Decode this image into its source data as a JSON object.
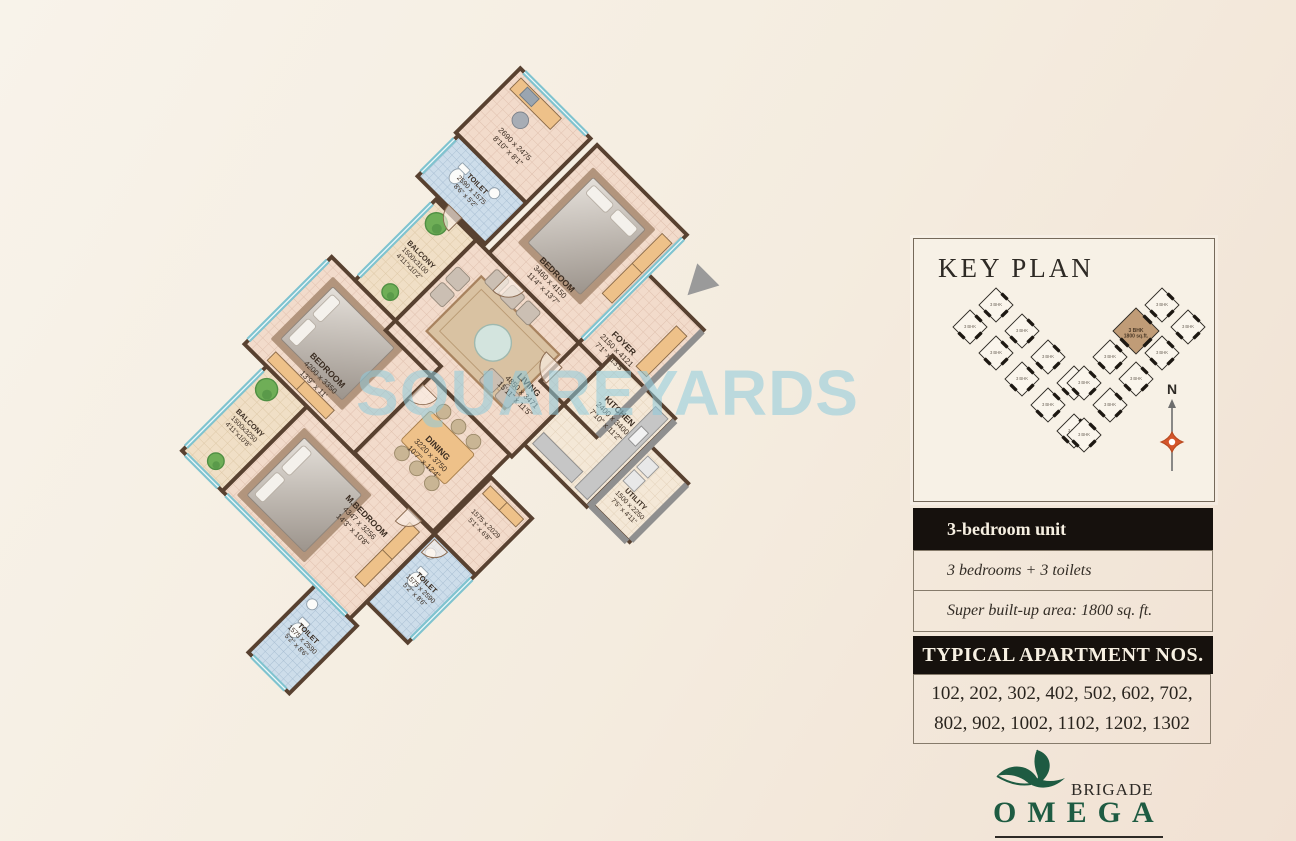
{
  "watermark": "SQUAREYARDS",
  "colors": {
    "wall": "#584130",
    "window": "#7fc3cf",
    "accent_wood": "#eec189",
    "toilet_floor": "#cdddea",
    "room_floor": "#f2dbcb",
    "plant": "#6fae57",
    "dark_bar": "#16110d",
    "brand_green": "#1e5b42",
    "compass": "#d4552b",
    "keyplan_highlight": "#c09c77",
    "watermark_blue": "#8ecbdd"
  },
  "floor_plan": {
    "rooms": [
      {
        "id": "study",
        "name": "",
        "dim_mm": "2690 x 2475",
        "dim_ft": "8'10\" x 8'1\"",
        "type": "room",
        "x": 0,
        "y": 0,
        "w": 108,
        "h": 99
      },
      {
        "id": "toilet1",
        "name": "TOILET",
        "dim_mm": "2590 x 1575",
        "dim_ft": "8'6\" x 5'2\"",
        "type": "toilet",
        "x": 4,
        "y": 99,
        "w": 104,
        "h": 63
      },
      {
        "id": "bedroom1",
        "name": "BEDROOM",
        "dim_mm": "3460 x 4150",
        "dim_ft": "11'4\" x 13'7\"",
        "type": "bedroom",
        "x": 118,
        "y": 0,
        "w": 138,
        "h": 166
      },
      {
        "id": "foyer",
        "name": "FOYER",
        "dim_mm": "2150 x 4121",
        "dim_ft": "7'1\" x 13'5\"",
        "type": "room",
        "x": 256,
        "y": 60,
        "w": 86,
        "h": 165
      },
      {
        "id": "balcony-u",
        "name": "BALCONY",
        "dim_mm": "1500x3100",
        "dim_ft": "4'11\"x10'2\"",
        "type": "balcony",
        "x": 36,
        "y": 166,
        "w": 62,
        "h": 124
      },
      {
        "id": "living",
        "name": "LIVING",
        "dim_mm": "4850 x 3471",
        "dim_ft": "15'11\" x 11'5\"",
        "type": "room",
        "x": 98,
        "y": 166,
        "w": 194,
        "h": 139
      },
      {
        "id": "kitchen",
        "name": "KITCHEN",
        "dim_mm": "2400 x 3400",
        "dim_ft": "7'10\" x 11'2\"",
        "type": "kitchen",
        "x": 292,
        "y": 150,
        "w": 96,
        "h": 136
      },
      {
        "id": "utility",
        "name": "UTILITY",
        "dim_mm": "1500 x 2250",
        "dim_ft": "7'5\" x 4'11\"",
        "type": "utility",
        "x": 388,
        "y": 190,
        "w": 60,
        "h": 90
      },
      {
        "id": "dining",
        "name": "DINING",
        "dim_mm": "3220 x 3750",
        "dim_ft": "10'7\" x 12'4\"",
        "type": "room",
        "x": 168,
        "y": 305,
        "w": 121,
        "h": 118
      },
      {
        "id": "bedroom2",
        "name": "BEDROOM",
        "dim_mm": "4200 x 3350",
        "dim_ft": "13'9\" x 11'",
        "type": "bedroom",
        "x": 0,
        "y": 290,
        "w": 168,
        "h": 134
      },
      {
        "id": "passage",
        "name": "",
        "dim_mm": "1575 x 2029",
        "dim_ft": "5'1\" x 6'8\"",
        "type": "passage",
        "x": 292,
        "y": 337,
        "w": 63,
        "h": 87
      },
      {
        "id": "m-bedroom",
        "name": "M.BEDROOM",
        "dim_mm": "4347 x 3256",
        "dim_ft": "14'3\" x 10'8\"",
        "type": "bedroom",
        "x": 96,
        "y": 424,
        "w": 196,
        "h": 130
      },
      {
        "id": "toilet2",
        "name": "TOILET",
        "dim_mm": "1575 x 2590",
        "dim_ft": "5'2\" x 8'6\"",
        "type": "toilet",
        "x": 292,
        "y": 424,
        "w": 63,
        "h": 104
      },
      {
        "id": "toilet3",
        "name": "TOILET",
        "dim_mm": "1575 x 2590",
        "dim_ft": "5'2\" x 8'6\"",
        "type": "toilet",
        "x": 240,
        "y": 554,
        "w": 63,
        "h": 104
      },
      {
        "id": "balcony-l",
        "name": "BALCONY",
        "dim_mm": "1500x3250",
        "dim_ft": "4'11\"x10'8\"",
        "type": "balcony",
        "x": 34,
        "y": 424,
        "w": 62,
        "h": 130
      }
    ],
    "rotation_deg": 45
  },
  "key_plan": {
    "title": "KEY PLAN",
    "north_label": "N",
    "highlight_label": "3 BHK",
    "highlight_area": "1800 sq.ft.",
    "units": [
      {
        "x": 82,
        "y": 66,
        "label": "3 BHK"
      },
      {
        "x": 108,
        "y": 92,
        "label": "3 BHK"
      },
      {
        "x": 134,
        "y": 118,
        "label": "3 BHK"
      },
      {
        "x": 160,
        "y": 144,
        "label": "3 BHK"
      },
      {
        "x": 56,
        "y": 88,
        "label": "3 BHK"
      },
      {
        "x": 82,
        "y": 114,
        "label": "3 BHK"
      },
      {
        "x": 108,
        "y": 140,
        "label": "3 BHK"
      },
      {
        "x": 134,
        "y": 166,
        "label": "3 BHK"
      },
      {
        "x": 160,
        "y": 192,
        "label": "3 BHK"
      },
      {
        "x": 248,
        "y": 66,
        "label": "3 BHK"
      },
      {
        "x": 222,
        "y": 92,
        "label": "3 BHK",
        "highlight": true
      },
      {
        "x": 196,
        "y": 118,
        "label": "3 BHK"
      },
      {
        "x": 170,
        "y": 144,
        "label": "3 BHK"
      },
      {
        "x": 274,
        "y": 88,
        "label": "3 BHK"
      },
      {
        "x": 248,
        "y": 114,
        "label": "3 BHK"
      },
      {
        "x": 222,
        "y": 140,
        "label": "3 BHK"
      },
      {
        "x": 196,
        "y": 166,
        "label": "3 BHK"
      },
      {
        "x": 170,
        "y": 196,
        "label": "3 BHK"
      }
    ]
  },
  "unit_info": {
    "type_label": "3-bedroom unit",
    "config_label": "3 bedrooms + 3 toilets",
    "area_label": "Super built-up area: 1800 sq. ft.",
    "apartments_title": "TYPICAL APARTMENT NOS.",
    "apartment_numbers": "102, 202, 302, 402, 502, 602, 702, 802, 902, 1002, 1102, 1202, 1302"
  },
  "logo": {
    "brand": "BRIGADE",
    "name": "OMEGA",
    "tagline": "OFF KANAKAPURA ROAD"
  }
}
